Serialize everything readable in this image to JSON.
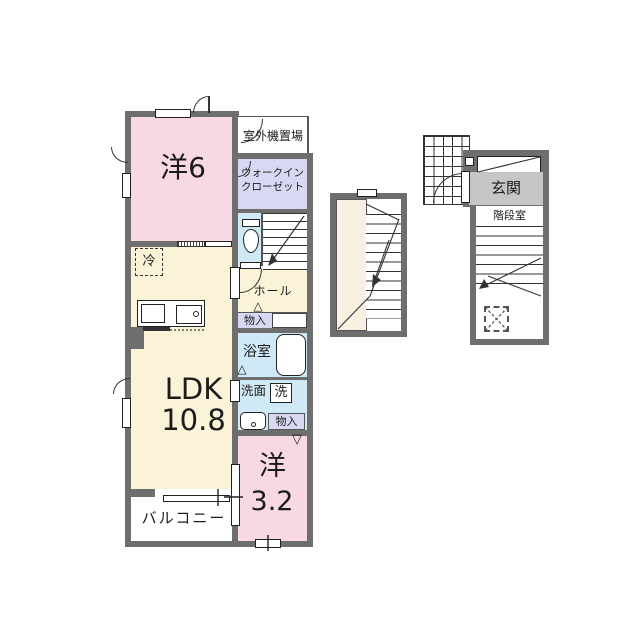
{
  "title": "apartment-floor-plan",
  "plan": {
    "rooms": {
      "bedroom1_label": "洋6",
      "ldk_line1": "LDK",
      "ldk_line2": "10.8",
      "bedroom2_line1": "洋",
      "bedroom2_line2": "3.2",
      "balcony_label": "バルコニー",
      "outdoor_unit_label": "室外機置場",
      "wic_line1": "ウォークイン",
      "wic_line2": "クローゼット",
      "hall_label": "ホール",
      "fridge_label": "冷",
      "storage_hall_label": "物入",
      "bath_label": "浴室",
      "washroom_label": "洗面",
      "washer_label": "洗",
      "storage_bedroom2_label": "物入"
    }
  },
  "annex": {
    "entrance_label": "玄関",
    "stairwell_label": "階段室"
  },
  "symbols": {
    "triangle_up": "△",
    "triangle_down": "▽"
  },
  "colors": {
    "room_pink": "#f8d8e4",
    "room_cream": "#fbf3d8",
    "room_lavender": "#d8d8f4",
    "room_lightblue": "#cfe9f6",
    "entrance_gray": "#c6c6c6",
    "wall_gray": "#6e6e6e",
    "stairhall_cream": "#faf0e2",
    "line_dark": "#1b1b1b"
  }
}
